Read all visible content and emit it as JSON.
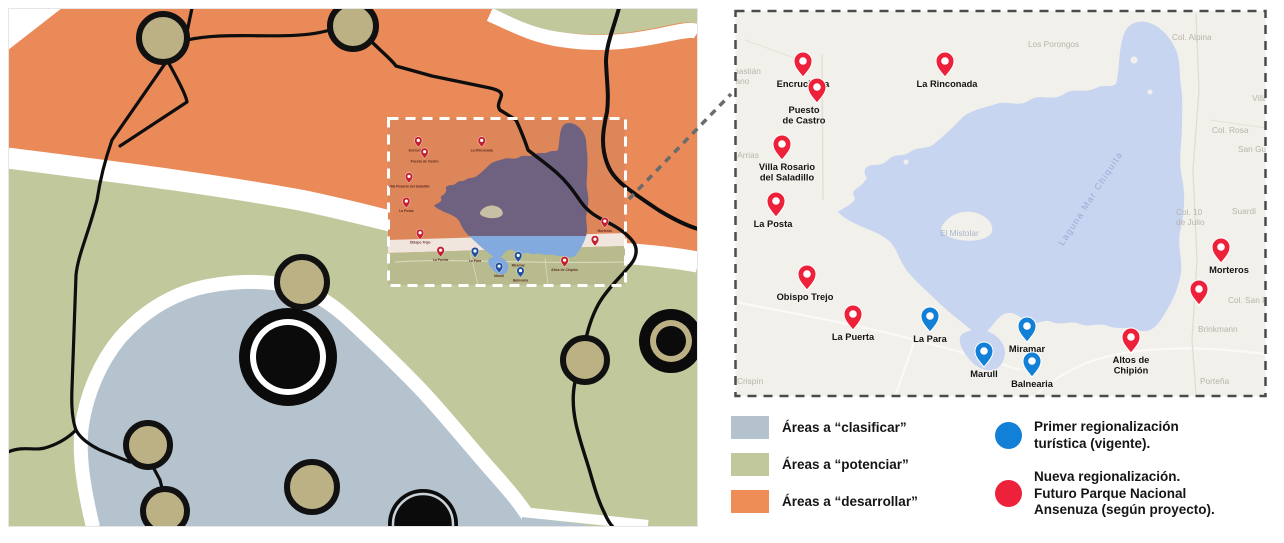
{
  "colors": {
    "area_clasificar": "#b3c2cc",
    "area_potenciar": "#c1c89c",
    "area_desarrollar": "#ee8d55",
    "nueva": "#ed2139",
    "primer": "#1380d8",
    "nueva_mini": "#c2202f",
    "primer_mini": "#1f4e9b"
  },
  "area_legend": {
    "items": [
      {
        "label": "Áreas a “clasificar”",
        "color": "#b3c2cc"
      },
      {
        "label": "Áreas a “potenciar”",
        "color": "#c1c89c"
      },
      {
        "label": "Áreas a “desarrollar”",
        "color": "#ee8d55"
      }
    ]
  },
  "pin_legend": {
    "items": [
      {
        "color": "#1380d8",
        "lines": [
          "Primer regionalización",
          "turística (vigente)."
        ]
      },
      {
        "color": "#ed2139",
        "lines": [
          "Nueva regionalización.",
          "Futuro Parque Nacional",
          "Ansenuza (según proyecto)."
        ]
      }
    ]
  },
  "detail_map": {
    "water_label": {
      "text": "Laguna Mar Chiquita",
      "x": 1093,
      "y": 200,
      "rotate": -57
    },
    "towns": [
      {
        "id": "encrucijada",
        "lines": [
          "Encrucijada"
        ],
        "x": 803,
        "y": 77,
        "type": "nueva"
      },
      {
        "id": "puesto-de-castro",
        "lines": [
          "Puesto",
          "de Castro"
        ],
        "x": 817,
        "y": 103,
        "dx": -13,
        "type": "nueva"
      },
      {
        "id": "la-rinconada",
        "lines": [
          "La Rinconada"
        ],
        "x": 945,
        "y": 77,
        "dx": 2,
        "type": "nueva"
      },
      {
        "id": "villa-rosario-del-saladillo",
        "lines": [
          "Villa Rosario",
          "del Saladillo"
        ],
        "x": 782,
        "y": 160,
        "dx": 5,
        "type": "nueva"
      },
      {
        "id": "la-posta",
        "lines": [
          "La Posta"
        ],
        "x": 776,
        "y": 217,
        "dx": -3,
        "type": "nueva"
      },
      {
        "id": "obispo-trejo",
        "lines": [
          "Obispo Trejo"
        ],
        "x": 807,
        "y": 290,
        "dx": -2,
        "type": "nueva"
      },
      {
        "id": "la-puerta",
        "lines": [
          "La Puerta"
        ],
        "x": 853,
        "y": 330,
        "type": "nueva"
      },
      {
        "id": "altos-de-chipion",
        "lines": [
          "Altos de",
          "Chipión"
        ],
        "x": 1131,
        "y": 353,
        "type": "nueva"
      },
      {
        "id": "morteros",
        "lines": [
          "Morteros"
        ],
        "x": 1221,
        "y": 263,
        "dx": 8,
        "type": "nueva"
      },
      {
        "id": "pin-sin-etiqueta",
        "lines": [],
        "x": 1199,
        "y": 305,
        "type": "nueva"
      },
      {
        "id": "la-para",
        "lines": [
          "La Para"
        ],
        "x": 930,
        "y": 332,
        "type": "primer"
      },
      {
        "id": "marull",
        "lines": [
          "Marull"
        ],
        "x": 984,
        "y": 367,
        "type": "primer"
      },
      {
        "id": "miramar",
        "lines": [
          "Miramar"
        ],
        "x": 1027,
        "y": 342,
        "type": "primer"
      },
      {
        "id": "balnearia",
        "lines": [
          "Balnearia"
        ],
        "x": 1032,
        "y": 377,
        "type": "primer"
      }
    ],
    "background_places": [
      {
        "lines": [
          "Sebastián",
          "Elcano"
        ],
        "x": 724,
        "y": 74
      },
      {
        "lines": [
          "Las Arrias"
        ],
        "x": 722,
        "y": 158
      },
      {
        "lines": [
          "Crispín"
        ],
        "x": 737,
        "y": 384
      },
      {
        "lines": [
          "Los Porongos"
        ],
        "x": 1028,
        "y": 47
      },
      {
        "lines": [
          "Col. Alpina"
        ],
        "x": 1172,
        "y": 40
      },
      {
        "lines": [
          "Villa Trinidad"
        ],
        "x": 1252,
        "y": 101
      },
      {
        "lines": [
          "Col. Rosa"
        ],
        "x": 1212,
        "y": 133
      },
      {
        "lines": [
          "San Guillermo"
        ],
        "x": 1238,
        "y": 152
      },
      {
        "lines": [
          "Col. 10",
          "de Julio"
        ],
        "x": 1176,
        "y": 215
      },
      {
        "lines": [
          "Suardi"
        ],
        "x": 1232,
        "y": 214
      },
      {
        "lines": [
          "Col. San Pedro"
        ],
        "x": 1228,
        "y": 303
      },
      {
        "lines": [
          "Brinkmann"
        ],
        "x": 1198,
        "y": 332
      },
      {
        "lines": [
          "Porteña"
        ],
        "x": 1200,
        "y": 384
      },
      {
        "lines": [
          "El Mistolar"
        ],
        "x": 940,
        "y": 236,
        "color": "#a9b5c9"
      }
    ]
  }
}
